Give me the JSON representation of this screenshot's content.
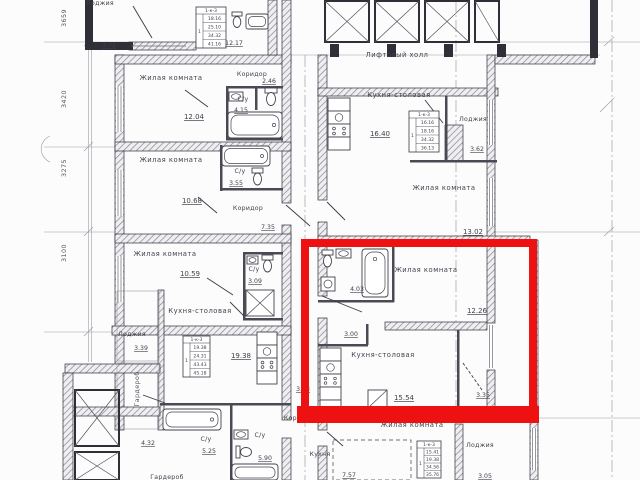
{
  "title": "Поэтажный план — выделенная квартира",
  "colors": {
    "highlight": "#ee1111",
    "paper": "#fcfcfd",
    "ink": "#2f2f38"
  },
  "legend": {
    "living_room": "Жилая комната",
    "kitchen_dining": "Кухня-столовая",
    "bathroom": "С/у",
    "corridor": "Коридор",
    "loggia": "Лоджия",
    "lift_hall": "Лифтовый холл",
    "wardrobe": "Гардероб",
    "kitchen": "Кухня"
  },
  "highlighted_apartment": {
    "living_room_area": "12.26",
    "kitchen_dining_area": "15.54",
    "bathroom_area": "4.03",
    "hall_area": "3.00",
    "loggia_area": "3.35"
  },
  "dimensions_left": [
    "3659",
    "3420",
    "3275",
    "3100"
  ],
  "texts": [
    {
      "n": "label-loggia-topleft",
      "v": "Лоджия",
      "x": 100,
      "y": 5,
      "cls": "room-s"
    },
    {
      "n": "area-loggia-topleft",
      "v": "3.71",
      "x": 109,
      "y": 47,
      "cls": "area-s"
    },
    {
      "n": "dim-3659",
      "v": "3659",
      "x": 66,
      "y": 18,
      "cls": "dim",
      "rot": -90
    },
    {
      "n": "dim-3420",
      "v": "3420",
      "x": 66,
      "y": 99,
      "cls": "dim",
      "rot": -90
    },
    {
      "n": "dim-3275",
      "v": "3275",
      "x": 66,
      "y": 168,
      "cls": "dim",
      "rot": -90
    },
    {
      "n": "dim-3100",
      "v": "3100",
      "x": 66,
      "y": 253,
      "cls": "dim",
      "rot": -90
    },
    {
      "n": "area-room-top",
      "v": "12.17",
      "x": 234,
      "y": 45,
      "cls": "area-s"
    },
    {
      "n": "label-living-1",
      "v": "Жилая комната",
      "x": 171,
      "y": 80,
      "cls": "room"
    },
    {
      "n": "area-living-1",
      "v": "12.04",
      "x": 194,
      "y": 119,
      "cls": "area"
    },
    {
      "n": "label-corridor-1",
      "v": "Коридор",
      "x": 252,
      "y": 76,
      "cls": "room-s"
    },
    {
      "n": "area-corridor-1",
      "v": "2.46",
      "x": 269,
      "y": 83,
      "cls": "area-s"
    },
    {
      "n": "label-bath-1",
      "v": "С/у",
      "x": 243,
      "y": 101,
      "cls": "room-s"
    },
    {
      "n": "area-bath-1",
      "v": "4.15",
      "x": 241,
      "y": 112,
      "cls": "area-s"
    },
    {
      "n": "label-living-2",
      "v": "Жилая комната",
      "x": 171,
      "y": 162,
      "cls": "room"
    },
    {
      "n": "area-living-2",
      "v": "10.68",
      "x": 192,
      "y": 203,
      "cls": "area"
    },
    {
      "n": "label-bath-2",
      "v": "С/у",
      "x": 240,
      "y": 173,
      "cls": "room-s"
    },
    {
      "n": "area-bath-2",
      "v": "3.55",
      "x": 236,
      "y": 185,
      "cls": "area-s"
    },
    {
      "n": "label-corridor-2",
      "v": "Коридор",
      "x": 248,
      "y": 210,
      "cls": "room-s"
    },
    {
      "n": "area-corridor-2",
      "v": "7.35",
      "x": 268,
      "y": 229,
      "cls": "area-s"
    },
    {
      "n": "label-living-3",
      "v": "Жилая комната",
      "x": 165,
      "y": 256,
      "cls": "room"
    },
    {
      "n": "area-living-3",
      "v": "10.59",
      "x": 190,
      "y": 276,
      "cls": "area"
    },
    {
      "n": "label-bath-3",
      "v": "С/у",
      "x": 254,
      "y": 271,
      "cls": "room-s"
    },
    {
      "n": "area-bath-3",
      "v": "3.09",
      "x": 255,
      "y": 283,
      "cls": "area-s"
    },
    {
      "n": "label-lift-hall",
      "v": "Лифтовый холл",
      "x": 397,
      "y": 57,
      "cls": "room"
    },
    {
      "n": "label-kitchen-dining-right",
      "v": "Кухня-столовая",
      "x": 399,
      "y": 97,
      "cls": "room"
    },
    {
      "n": "area-kitchen-dining-right",
      "v": "16.40",
      "x": 380,
      "y": 136,
      "cls": "area"
    },
    {
      "n": "label-loggia-right",
      "v": "Лоджия",
      "x": 473,
      "y": 121,
      "cls": "room-s"
    },
    {
      "n": "area-loggia-right",
      "v": "3.62",
      "x": 477,
      "y": 151,
      "cls": "area-s"
    },
    {
      "n": "label-living-right",
      "v": "Жилая комната",
      "x": 444,
      "y": 190,
      "cls": "room"
    },
    {
      "n": "area-living-right",
      "v": "13.02",
      "x": 473,
      "y": 234,
      "cls": "area"
    },
    {
      "n": "label-loggia-left",
      "v": "Лоджия",
      "x": 132,
      "y": 336,
      "cls": "room-s"
    },
    {
      "n": "area-loggia-left",
      "v": "3.39",
      "x": 141,
      "y": 350,
      "cls": "area-s"
    },
    {
      "n": "label-kitchen-dining-center",
      "v": "Кухня-столовая",
      "x": 200,
      "y": 313,
      "cls": "room"
    },
    {
      "n": "area-kitchen-dining-center",
      "v": "19.38",
      "x": 241,
      "y": 358,
      "cls": "area"
    },
    {
      "n": "label-wardrobe",
      "v": "Гардероб",
      "x": 139,
      "y": 389,
      "cls": "dim",
      "rot": -90
    },
    {
      "n": "area-hall-4",
      "v": "4.32",
      "x": 148,
      "y": 445,
      "cls": "area-s"
    },
    {
      "n": "label-bath-4",
      "v": "С/у",
      "x": 206,
      "y": 441,
      "cls": "room-s"
    },
    {
      "n": "area-bath-4",
      "v": "5.25",
      "x": 209,
      "y": 453,
      "cls": "area-s"
    },
    {
      "n": "label-bath-5",
      "v": "С/у",
      "x": 260,
      "y": 437,
      "cls": "room-s"
    },
    {
      "n": "area-bath-5",
      "v": "5.90",
      "x": 265,
      "y": 460,
      "cls": "area-s"
    },
    {
      "n": "label-kitchen-bottom",
      "v": "Кухня",
      "x": 320,
      "y": 456,
      "cls": "room-s"
    },
    {
      "n": "area-kitchen-bottom",
      "v": "7.57",
      "x": 349,
      "y": 477,
      "cls": "area-s"
    },
    {
      "n": "label-corridor-bottom",
      "v": "Коридор",
      "x": 299,
      "y": 420,
      "cls": "room-s"
    },
    {
      "n": "area-corridor-mid",
      "v": "3.13",
      "x": 303,
      "y": 391,
      "cls": "area-s"
    },
    {
      "n": "area-bath-hl",
      "v": "4.03",
      "x": 357,
      "y": 291,
      "cls": "area-s"
    },
    {
      "n": "label-living-hl",
      "v": "Жилая комната",
      "x": 426,
      "y": 272,
      "cls": "room"
    },
    {
      "n": "area-living-hl",
      "v": "12.26",
      "x": 477,
      "y": 313,
      "cls": "area"
    },
    {
      "n": "area-corridor-hl",
      "v": "3.00",
      "x": 351,
      "y": 336,
      "cls": "area-s"
    },
    {
      "n": "label-kitchen-dining-hl",
      "v": "Кухня-столовая",
      "x": 383,
      "y": 357,
      "cls": "room"
    },
    {
      "n": "area-kitchen-dining-hl",
      "v": "15.54",
      "x": 404,
      "y": 400,
      "cls": "area"
    },
    {
      "n": "area-loggia-hl",
      "v": "3.35",
      "x": 483,
      "y": 397,
      "cls": "area-s"
    },
    {
      "n": "label-living-bottom",
      "v": "Жилая комната",
      "x": 412,
      "y": 427,
      "cls": "room"
    },
    {
      "n": "label-loggia-bottom",
      "v": "Лоджия",
      "x": 480,
      "y": 447,
      "cls": "room-s"
    },
    {
      "n": "area-loggia-bottom",
      "v": "3.05",
      "x": 485,
      "y": 478,
      "cls": "area-s"
    },
    {
      "n": "label-wardrobe-bottom",
      "v": "Гардероб",
      "x": 167,
      "y": 479,
      "cls": "room-s"
    }
  ],
  "stamps": [
    {
      "n": "stamp-top-left",
      "x": 196,
      "y": 7,
      "w": 30,
      "h": 41,
      "header": "1-к-3",
      "side": "1",
      "rows": [
        "18.16",
        "25.10",
        "34.32",
        "41.16"
      ]
    },
    {
      "n": "stamp-right",
      "x": 409,
      "y": 111,
      "w": 30,
      "h": 41,
      "header": "1-к-3",
      "side": "1",
      "rows": [
        "16.16",
        "18.16",
        "34.32",
        "36.13"
      ]
    },
    {
      "n": "stamp-center",
      "x": 183,
      "y": 336,
      "w": 27,
      "h": 41,
      "header": "1-к-3",
      "side": "1",
      "rows": [
        "19.38",
        "24.31",
        "43.43",
        "45.18"
      ]
    },
    {
      "n": "stamp-bottom",
      "x": 417,
      "y": 441,
      "w": 24,
      "h": 37,
      "header": "1-к-3",
      "side": "1",
      "rows": [
        "15.41",
        "19.38",
        "34.56",
        "35.76"
      ]
    }
  ]
}
